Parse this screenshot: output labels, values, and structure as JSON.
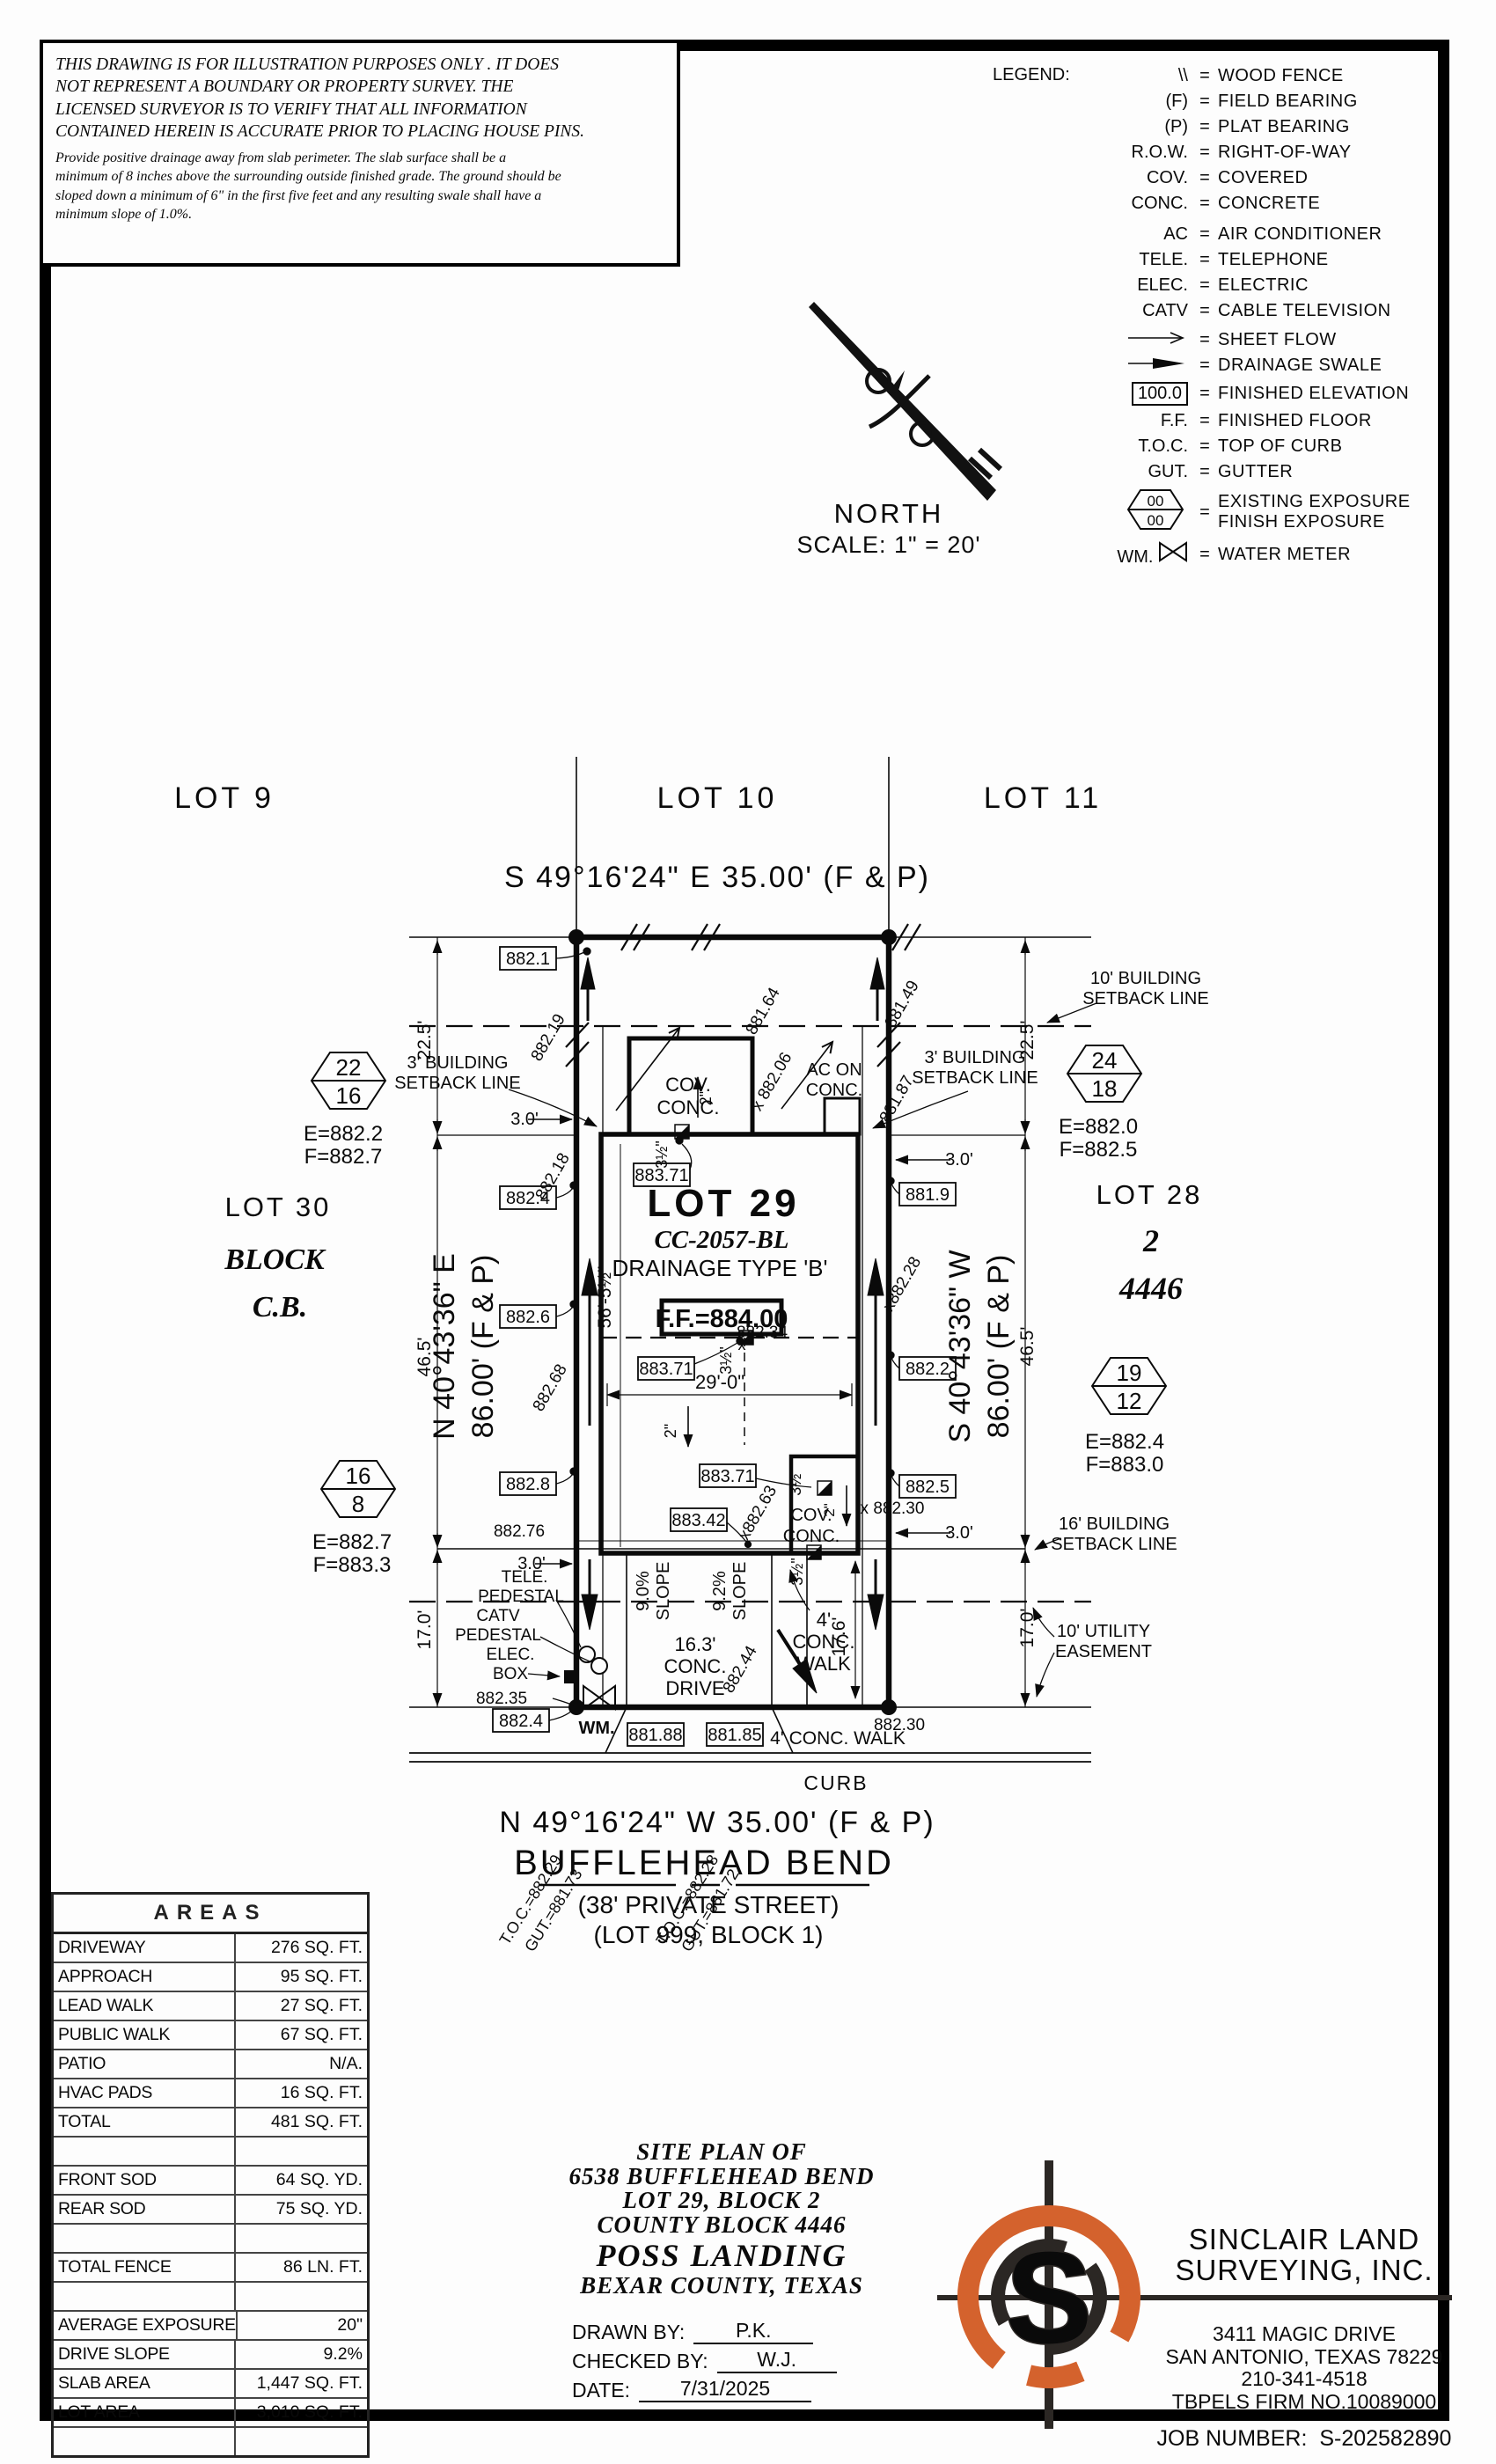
{
  "disclaimer": {
    "line1": "THIS DRAWING IS FOR ILLUSTRATION PURPOSES ONLY . IT DOES",
    "line2": "NOT REPRESENT A BOUNDARY OR PROPERTY SURVEY. THE",
    "line3": "LICENSED SURVEYOR IS TO VERIFY THAT ALL INFORMATION",
    "line4": "CONTAINED HEREIN IS ACCURATE PRIOR TO PLACING HOUSE PINS.",
    "note1": "Provide positive drainage away from slab perimeter. The slab surface shall be a",
    "note2": "minimum of 8 inches above the surrounding outside finished grade. The ground should be",
    "note3": "sloped down a minimum of 6\" in the first five feet and any resulting swale shall have a",
    "note4": "minimum slope of 1.0%."
  },
  "legend": {
    "title": "LEGEND:",
    "eq": "=",
    "items": [
      {
        "sym": "\\\\",
        "desc": "WOOD FENCE"
      },
      {
        "sym": "(F)",
        "desc": "FIELD BEARING"
      },
      {
        "sym": "(P)",
        "desc": "PLAT BEARING"
      },
      {
        "sym": "R.O.W.",
        "desc": "RIGHT-OF-WAY"
      },
      {
        "sym": "COV.",
        "desc": "COVERED"
      },
      {
        "sym": "CONC.",
        "desc": "CONCRETE"
      },
      {
        "sym": "AC",
        "desc": "AIR CONDITIONER"
      },
      {
        "sym": "TELE.",
        "desc": "TELEPHONE"
      },
      {
        "sym": "ELEC.",
        "desc": "ELECTRIC"
      },
      {
        "sym": "CATV",
        "desc": "CABLE TELEVISION"
      },
      {
        "sym": "",
        "desc": "SHEET FLOW"
      },
      {
        "sym": "",
        "desc": "DRAINAGE SWALE"
      },
      {
        "sym": "100.0",
        "desc": "FINISHED ELEVATION"
      },
      {
        "sym": "F.F.",
        "desc": "FINISHED FLOOR"
      },
      {
        "sym": "T.O.C.",
        "desc": "TOP OF CURB"
      },
      {
        "sym": "GUT.",
        "desc": "GUTTER"
      },
      {
        "sym": "00",
        "sym2": "00",
        "desc": "EXISTING EXPOSURE",
        "desc2": "FINISH EXPOSURE"
      },
      {
        "sym": "WM.",
        "desc": "WATER METER"
      }
    ]
  },
  "north": {
    "label": "NORTH",
    "scale": "SCALE: 1\" = 20'"
  },
  "plan": {
    "lot9": "LOT 9",
    "lot10": "LOT 10",
    "lot11": "LOT 11",
    "lot30": "LOT 30",
    "block_word": "BLOCK",
    "cb": "C.B.",
    "lot28": "LOT 28",
    "blk2": "2",
    "cb4446": "4446",
    "lot29": "LOT 29",
    "cc": "CC-2057-BL",
    "drainage": "DRAINAGE TYPE 'B'",
    "ff": "F.F.=884.00",
    "bearing_top": "S 49°16'24\" E 35.00' (F & P)",
    "bearing_bottom": "N 49°16'24\" W 35.00' (F & P)",
    "brg_left1": "N 40°43'36\" E",
    "brg_left2": "86.00' (F & P)",
    "brg_right1": "S 40°43'36\" W",
    "brg_right2": "86.00' (F & P)",
    "street": "BUFFLEHEAD BEND",
    "street2": "(38' PRIVATE STREET)",
    "street3": "(LOT 999, BLOCK 1)",
    "sb10_1": "10' BUILDING",
    "sb10_2": "SETBACK LINE",
    "sb3_1": "3' BUILDING",
    "sb3_2": "SETBACK LINE",
    "sb16_1": "16' BUILDING",
    "sb16_2": "SETBACK LINE",
    "ue1": "10' UTILITY",
    "ue2": "EASEMENT",
    "d225": "22.5'",
    "d465": "46.5'",
    "d170": "17.0'",
    "d30": "3.0'",
    "d29": "29'-0\"",
    "d56": "56'-5½\"",
    "d176": "17.6'",
    "d163a": "16.3'",
    "d163b": "CONC.",
    "d163c": "DRIVE",
    "covc1": "COV.",
    "covc2": "CONC.",
    "ac1": "AC ON",
    "ac2": "CONC.",
    "s90": "9.0%",
    "s92": "9.2%",
    "slope": "SLOPE",
    "w41": "4'",
    "w42": "CONC.",
    "w43": "WALK",
    "walkb": "4' CONC. WALK",
    "curb": "CURB",
    "wm": "WM.",
    "two": "2\"",
    "th": "3½\"",
    "xmark": "x",
    "h22a": "22",
    "h22b": "16",
    "h22e": "E=882.2",
    "h22f": "F=882.7",
    "h24a": "24",
    "h24b": "18",
    "h24e": "E=882.0",
    "h24f": "F=882.5",
    "h16a": "16",
    "h16b": "8",
    "h16e": "E=882.7",
    "h16f": "F=883.3",
    "h19a": "19",
    "h19b": "12",
    "h19e": "E=882.4",
    "h19f": "F=883.0",
    "b8821": "882.1",
    "b8824": "882.4",
    "b8826": "882.6",
    "b8828": "882.8",
    "b8819": "881.9",
    "b8822": "882.2",
    "b8825": "882.5",
    "b88371": "883.71",
    "b88342": "883.42",
    "b88188": "881.88",
    "b88185": "881.85",
    "x88219": "882.19",
    "x88164": "881.64",
    "x88149": "881.49",
    "x88187": "881.87",
    "x88206": "x 882.06",
    "x88218": "882.18",
    "x88268": "882.68",
    "x88276": "882.76",
    "x88228": "x882.28",
    "x88230": "x 882.30",
    "x88230b": "882.30",
    "x88263": "x882.63",
    "x88244": "882.44",
    "x88234": "882.34",
    "x88235": "882.35",
    "toc1": "T.O.C.=882.29",
    "gut1": "GUT.=881.73",
    "toc2": "T.O.C.=882.28",
    "gut2": "GUT.=881.72"
  },
  "areas": {
    "title": "AREAS",
    "rows": [
      {
        "label": "DRIVEWAY",
        "value": "276 SQ. FT."
      },
      {
        "label": "APPROACH",
        "value": "95 SQ. FT."
      },
      {
        "label": "LEAD WALK",
        "value": "27 SQ. FT."
      },
      {
        "label": "PUBLIC WALK",
        "value": "67 SQ. FT."
      },
      {
        "label": "PATIO",
        "value": "N/A."
      },
      {
        "label": "HVAC PADS",
        "value": "16 SQ. FT."
      },
      {
        "label": "TOTAL",
        "value": "481 SQ. FT."
      },
      {
        "label": "",
        "value": ""
      },
      {
        "label": "FRONT SOD",
        "value": "64 SQ. YD."
      },
      {
        "label": "REAR SOD",
        "value": "75 SQ. YD."
      },
      {
        "label": "",
        "value": ""
      },
      {
        "label": "TOTAL FENCE",
        "value": "86 LN. FT."
      },
      {
        "label": "",
        "value": ""
      },
      {
        "label": "AVERAGE EXPOSURE",
        "value": "20\""
      },
      {
        "label": "DRIVE SLOPE",
        "value": "9.2%"
      },
      {
        "label": "SLAB AREA",
        "value": "1,447 SQ. FT."
      },
      {
        "label": "LOT AREA",
        "value": "3,010 SQ. FT."
      },
      {
        "label": "",
        "value": ""
      }
    ]
  },
  "title_block": {
    "l1": "SITE PLAN OF",
    "l2": "6538 BUFFLEHEAD BEND",
    "l3": "LOT 29, BLOCK 2",
    "l4": "COUNTY BLOCK 4446",
    "l5": "POSS LANDING",
    "l6": "BEXAR COUNTY, TEXAS",
    "drawn_label": "DRAWN BY:",
    "drawn": "P.K.",
    "checked_label": "CHECKED BY:",
    "checked": "W.J.",
    "date_label": "DATE:",
    "date": "7/31/2025"
  },
  "company": {
    "logo_letter": "S",
    "name1": "SINCLAIR LAND",
    "name2": "SURVEYING, INC.",
    "addr1": "3411 MAGIC DRIVE",
    "addr2": "SAN ANTONIO, TEXAS 78229",
    "phone": "210-341-4518",
    "firm": "TBPELS FIRM NO.10089000",
    "job_label": "JOB NUMBER:",
    "job": "S-202582890"
  },
  "colors": {
    "accent": "#d4622d",
    "ink": "#0a0a0a"
  }
}
